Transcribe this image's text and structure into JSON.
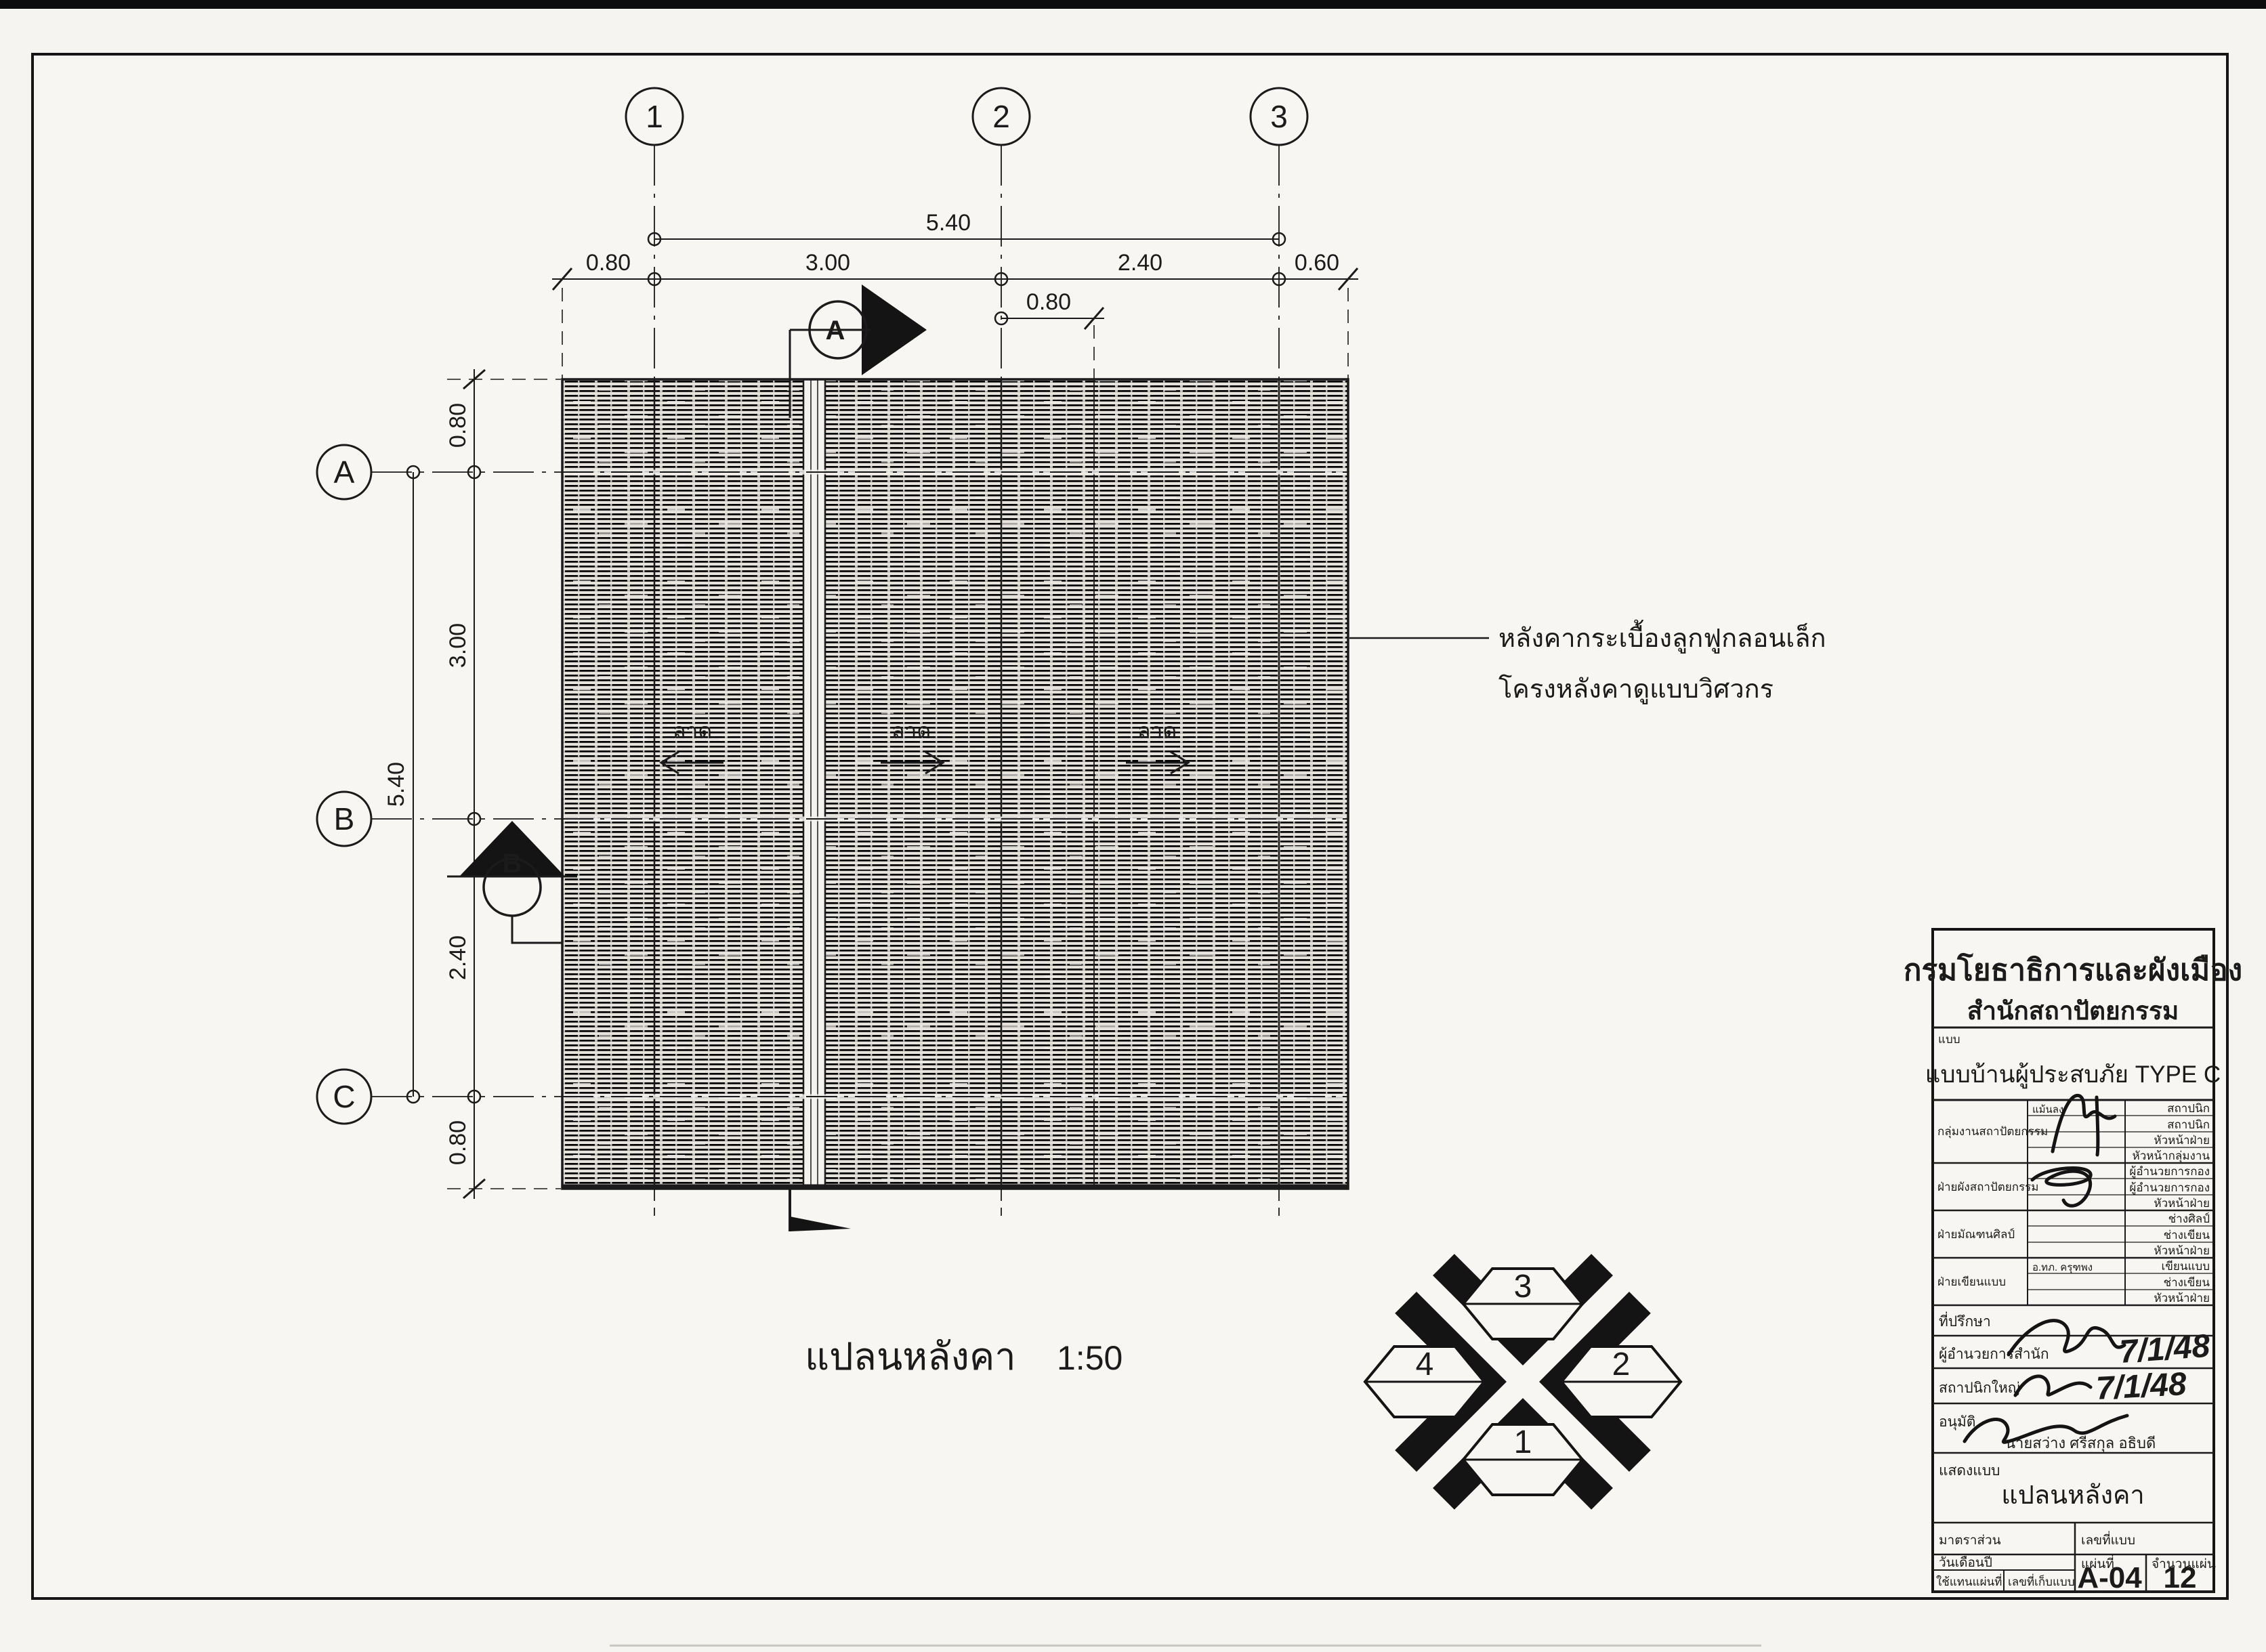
{
  "page": {
    "bg": "#f5f4f0",
    "ink": "#1b1b1b"
  },
  "plan": {
    "title": "แปลนหลังคา",
    "scale": "1:50",
    "grid_cols": [
      "1",
      "2",
      "3"
    ],
    "grid_rows": [
      "A",
      "B",
      "C"
    ],
    "dim_top_total": "5.40",
    "dims_top": [
      "0.80",
      "3.00",
      "2.40",
      "0.60"
    ],
    "dim_top_sub": "0.80",
    "dim_left_total": "5.40",
    "dims_left": [
      "0.80",
      "3.00",
      "2.40",
      "0.80"
    ],
    "slope_label": "ลาด",
    "note_line1": "หลังคากระเบื้องลูกฟูกลอนเล็ก",
    "note_line2": "โครงหลังคาดูแบบวิศวกร",
    "section_a": "A",
    "section_b": "B"
  },
  "orientation": {
    "top": "3",
    "right": "2",
    "bottom": "1",
    "left": "4"
  },
  "titleblock": {
    "agency": "กรมโยธาธิการและผังเมือง",
    "bureau": "สำนักสถาปัตยกรรม",
    "form_label": "แบบ",
    "project": "แบบบ้านผู้ประสบภัย TYPE C",
    "groups": [
      {
        "label": "กลุ่มงานสถาปัตยกรรม",
        "name": "แม้นลง",
        "roles": [
          "สถาปนิก",
          "สถาปนิก",
          "หัวหน้าฝ่าย",
          "หัวหน้ากลุ่มงาน"
        ]
      },
      {
        "label": "ฝ่ายผังสถาปัตยกรรม",
        "name": "",
        "roles": [
          "ผู้อำนวยการกอง",
          "ผู้อำนวยการกอง",
          "หัวหน้าฝ่าย"
        ]
      },
      {
        "label": "ฝ่ายมัณฑนศิลป์",
        "name": "",
        "roles": [
          "ช่างศิลป์",
          "ช่างเขียน",
          "หัวหน้าฝ่าย"
        ]
      },
      {
        "label": "ฝ่ายเขียนแบบ",
        "name": "อ.ทภ. ครุฑพง",
        "roles": [
          "เขียนแบบ",
          "ช่างเขียน",
          "หัวหน้าฝ่าย"
        ]
      }
    ],
    "consultant_label": "ที่ปรึกษา",
    "director_label": "ผู้อำนวยการสำนัก",
    "director_date": "7/1/48",
    "chief_architect_label": "สถาปนิกใหญ่",
    "chief_architect_date": "7/1/48",
    "approve_label": "อนุมัติ",
    "approver": "นายสว่าง  ศรีสกุล  อธิบดี",
    "sheetname_label": "แสดงแบบ",
    "sheetname": "แปลนหลังคา",
    "scale_label": "มาตราส่วน",
    "drawing_no_label": "เลขที่แบบ",
    "date_label": "วันเดือนปี",
    "replaces_label": "ใช้แทนแผ่นที่",
    "file_no_label": "เลขที่เก็บแบบ",
    "sheet_label": "แผ่นที่",
    "sheet_no": "A-04",
    "total_label": "จำนวนแผ่น",
    "total_sheets": "12"
  }
}
